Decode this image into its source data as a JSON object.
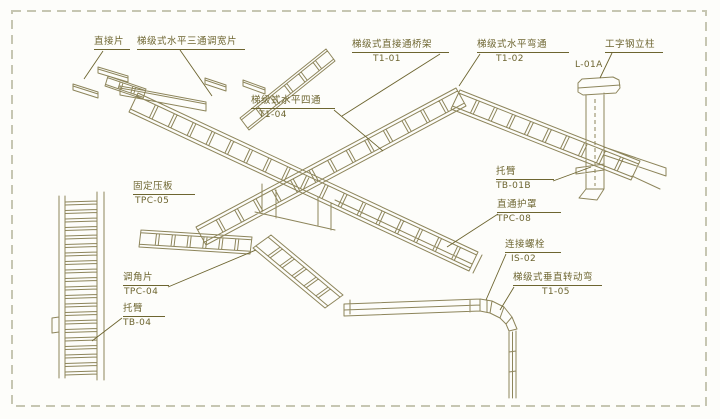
{
  "colors": {
    "line": "#8d855b",
    "text": "#6d6530",
    "border": "#c6c6b2",
    "bg": "#fdfdfa"
  },
  "labels": {
    "zhijiepian": {
      "name": "直接片",
      "code": ""
    },
    "santong": {
      "name": "梯级式水平三通调宽片",
      "code": ""
    },
    "t101": {
      "name": "梯级式直接通桥架",
      "code": "T1-01"
    },
    "t102": {
      "name": "梯级式水平弯通",
      "code": "T1-02"
    },
    "l01a": {
      "name": "工字钢立柱",
      "code": "L-01A"
    },
    "t104": {
      "name": "梯级式水平四通",
      "code": "T1-04"
    },
    "tb01b": {
      "name": "托臂",
      "code": "TB-01B"
    },
    "tpc08": {
      "name": "直通护罩",
      "code": "TPC-08"
    },
    "tpc05": {
      "name": "固定压板",
      "code": "TPC-05"
    },
    "is02": {
      "name": "连接螺栓",
      "code": "IS-02"
    },
    "t105": {
      "name": "梯级式垂直转动弯",
      "code": "T1-05"
    },
    "tpc04": {
      "name": "调角片",
      "code": "TPC-04"
    },
    "tb04": {
      "name": "托臂",
      "code": "TB-04"
    }
  }
}
